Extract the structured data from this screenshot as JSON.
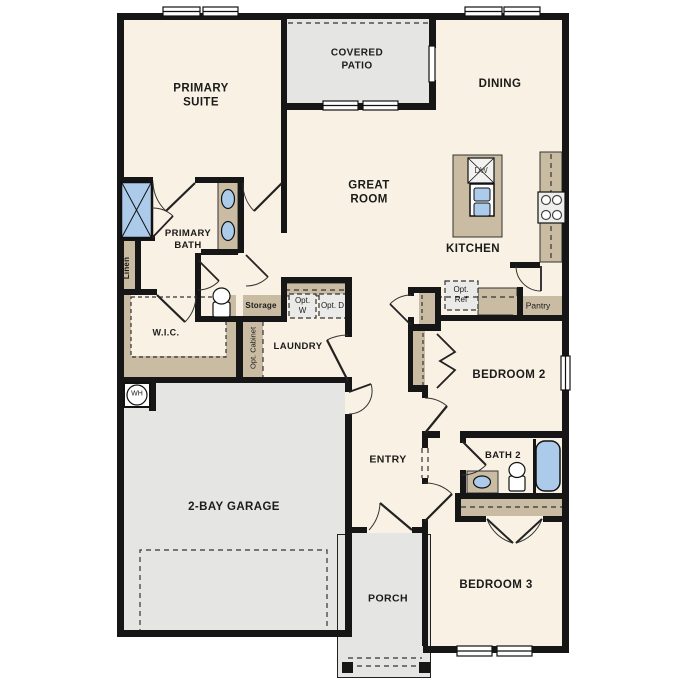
{
  "plan_title": "Single-story floor plan",
  "colors": {
    "wall": "#161616",
    "floor": "#f9f1e3",
    "exterior_concrete": "#e5e5e3",
    "cabinet_tan": "#c9bca3",
    "fixture_blue": "#accbea",
    "optional_item_fill": "#eaeae8"
  },
  "rooms": {
    "primary_suite": "PRIMARY SUITE",
    "covered_patio": "COVERED PATIO",
    "dining": "DINING",
    "great_room": "GREAT ROOM",
    "kitchen": "KITCHEN",
    "primary_bath": "PRIMARY BATH",
    "wic": "W.I.C.",
    "laundry": "LAUNDRY",
    "entry": "ENTRY",
    "garage": "2-BAY GARAGE",
    "porch": "PORCH",
    "bedroom2": "BEDROOM 2",
    "bath2": "BATH 2",
    "bedroom3": "BEDROOM 3"
  },
  "features": {
    "linen": "Linen",
    "storage": "Storage",
    "opt_cabinet": "Opt. Cabinet",
    "opt_washer": "Opt. W",
    "opt_dryer": "Opt. D",
    "opt_ref": "Opt. Ref",
    "pantry": "Pantry",
    "dishwasher": "DW",
    "water_heater": "WH"
  }
}
